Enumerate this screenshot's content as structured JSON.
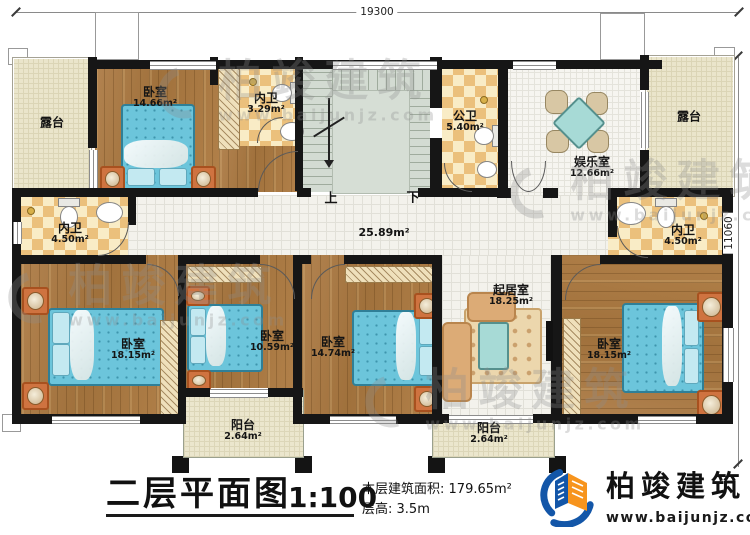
{
  "plan": {
    "dim_top": "19300",
    "dim_right": "11060",
    "corridor_area": "25.89m²",
    "stair_up": "上",
    "stair_down": "下",
    "rooms": [
      {
        "id": "terrace-left",
        "name": "露台",
        "area": ""
      },
      {
        "id": "bedroom-top-left",
        "name": "卧室",
        "area": "14.66m²"
      },
      {
        "id": "ensuite-bath-top",
        "name": "内卫",
        "area": "3.29m²"
      },
      {
        "id": "public-bath",
        "name": "公卫",
        "area": "5.40m²"
      },
      {
        "id": "recreation-room",
        "name": "娱乐室",
        "area": "12.66m²"
      },
      {
        "id": "terrace-right",
        "name": "露台",
        "area": ""
      },
      {
        "id": "ensuite-bath-left",
        "name": "内卫",
        "area": "4.50m²"
      },
      {
        "id": "ensuite-bath-right",
        "name": "内卫",
        "area": "4.50m²"
      },
      {
        "id": "bedroom-bottom-left",
        "name": "卧室",
        "area": "18.15m²"
      },
      {
        "id": "bedroom-second",
        "name": "卧室",
        "area": "10.59m²"
      },
      {
        "id": "balcony-left",
        "name": "阳台",
        "area": "2.64m²"
      },
      {
        "id": "bedroom-third",
        "name": "卧室",
        "area": "14.74m²"
      },
      {
        "id": "living-room",
        "name": "起居室",
        "area": "18.25m²"
      },
      {
        "id": "balcony-right",
        "name": "阳台",
        "area": "2.64m²"
      },
      {
        "id": "bedroom-bottom-right",
        "name": "卧室",
        "area": "18.15m²"
      }
    ]
  },
  "titleblock": {
    "title": "二层平面图",
    "scale": "1:100",
    "floor_area_label": "本层建筑面积:",
    "floor_area_value": "179.65m²",
    "floor_height_label": "层高:",
    "floor_height_value": "3.5m"
  },
  "brand": {
    "name": "柏竣建筑",
    "website": "www.baijunjz.com"
  },
  "watermark": {
    "text": "柏竣建筑",
    "url": "www.baijunjz.com"
  }
}
